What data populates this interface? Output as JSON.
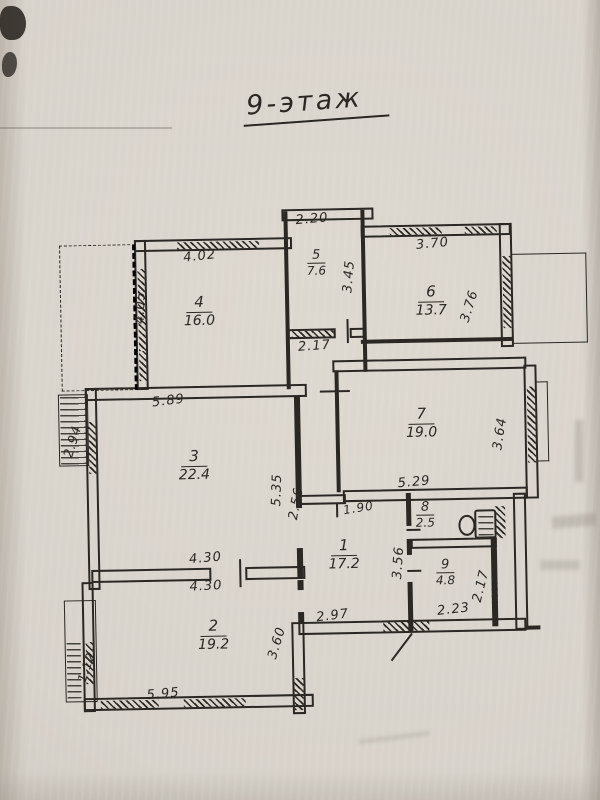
{
  "document": {
    "title": "9-этаж",
    "type_hint": "scanned apartment floor plan"
  },
  "rooms": [
    {
      "number": "1",
      "area": "17.2"
    },
    {
      "number": "2",
      "area": "19.2"
    },
    {
      "number": "3",
      "area": "22.4"
    },
    {
      "number": "4",
      "area": "16.0"
    },
    {
      "number": "5",
      "area": "7.6"
    },
    {
      "number": "6",
      "area": "13.7"
    },
    {
      "number": "7",
      "area": "19.0"
    },
    {
      "number": "8",
      "area": "2.5"
    },
    {
      "number": "9",
      "area": "4.8"
    }
  ],
  "dims": [
    {
      "text": "2.20"
    },
    {
      "text": "4.02"
    },
    {
      "text": "3.70"
    },
    {
      "text": "4.05"
    },
    {
      "text": "3.45"
    },
    {
      "text": "3.76"
    },
    {
      "text": "2.17"
    },
    {
      "text": "5.89"
    },
    {
      "text": "5.29"
    },
    {
      "text": "3.64"
    },
    {
      "text": "5.35"
    },
    {
      "text": "2.56"
    },
    {
      "text": "2.94"
    },
    {
      "text": "4.30"
    },
    {
      "text": "4.30"
    },
    {
      "text": "1.90"
    },
    {
      "text": "3.56"
    },
    {
      "text": "2.23"
    },
    {
      "text": "2.17"
    },
    {
      "text": "2.97"
    },
    {
      "text": "3.60"
    },
    {
      "text": "1.12"
    },
    {
      "text": "5.95"
    }
  ]
}
